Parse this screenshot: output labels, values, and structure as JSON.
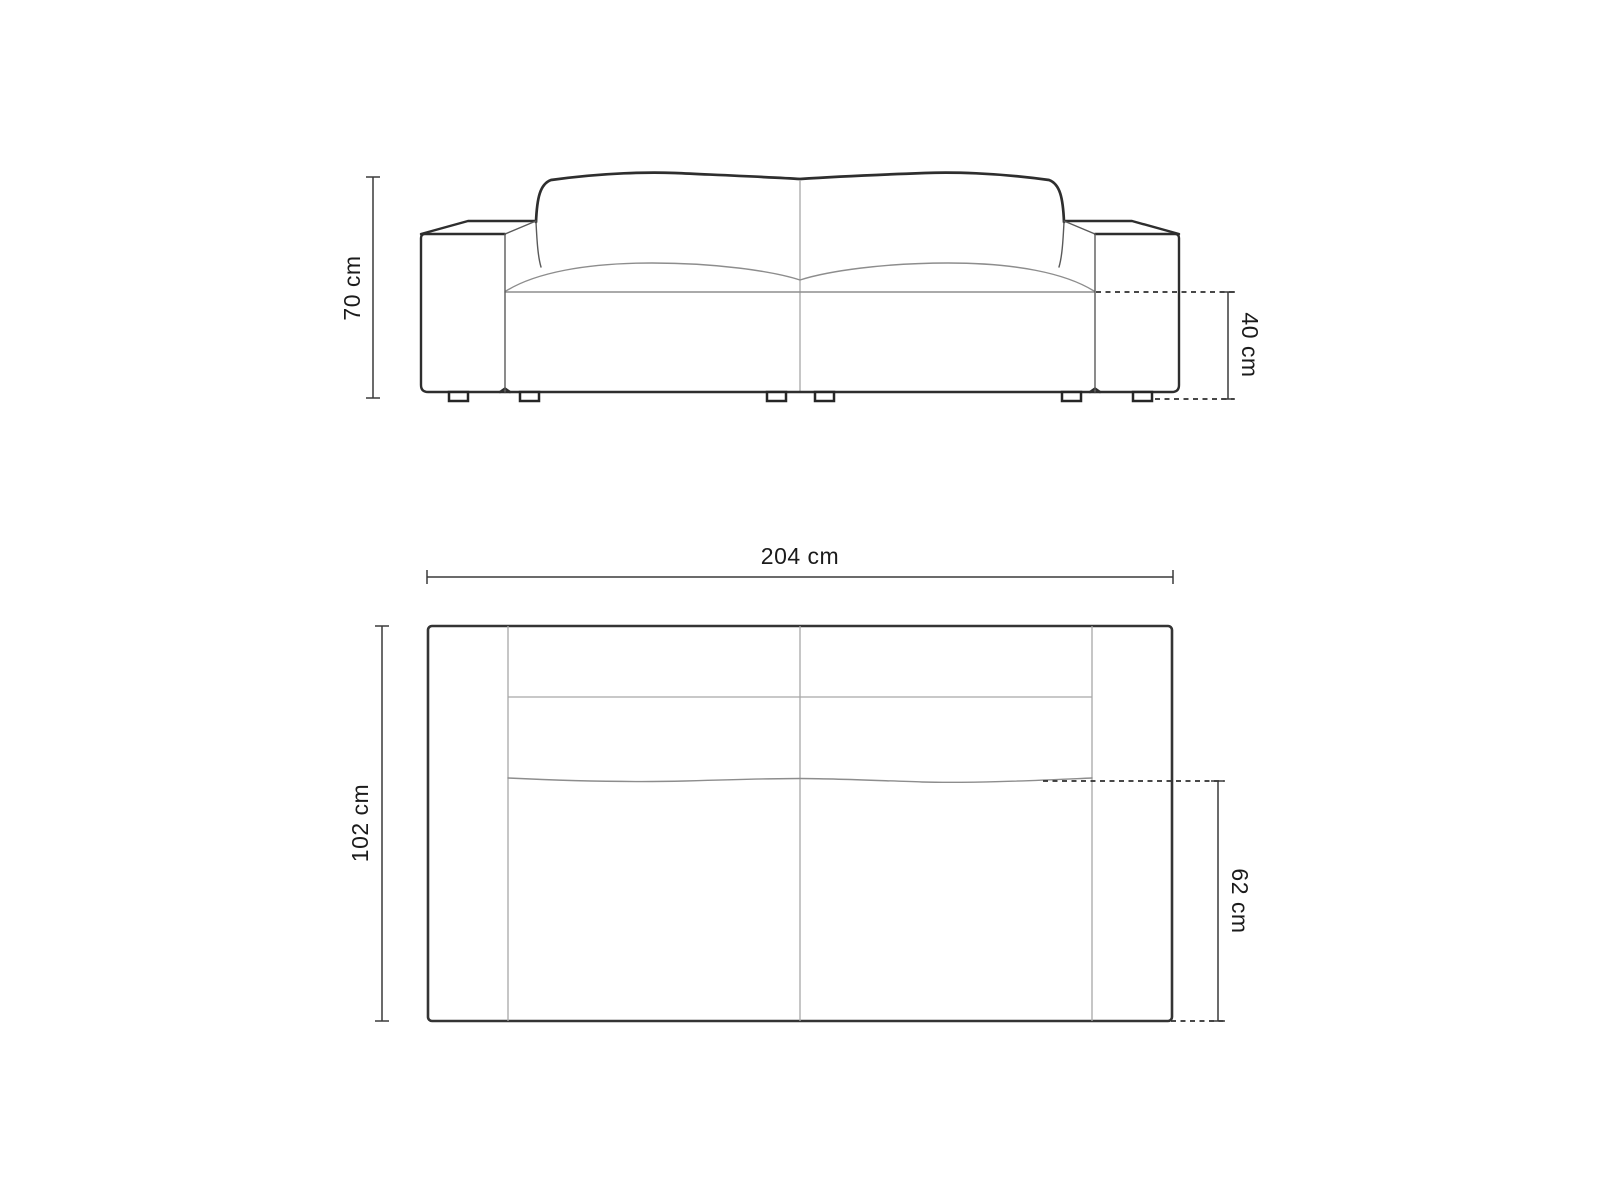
{
  "figure": {
    "kind": "furniture-dimension-drawing",
    "subject": "two-seat sofa",
    "views": [
      "front elevation",
      "top plan"
    ]
  },
  "dimensions": {
    "front_height": {
      "label": "70 cm",
      "value": 70,
      "unit": "cm"
    },
    "seat_height": {
      "label": "40 cm",
      "value": 40,
      "unit": "cm"
    },
    "width": {
      "label": "204 cm",
      "value": 204,
      "unit": "cm"
    },
    "depth": {
      "label": "102 cm",
      "value": 102,
      "unit": "cm"
    },
    "seat_depth": {
      "label": "62 cm",
      "value": 62,
      "unit": "cm"
    }
  },
  "colors": {
    "background": "#ffffff",
    "outline": "#2e2e2e",
    "medium_line": "#5a5a5a",
    "gray_line": "#8d8d8d",
    "light_line": "#a8a8a8",
    "dimension_line": "#3a3a3a",
    "dashed_line": "#2f2f2f",
    "text": "#1b1b1b"
  }
}
